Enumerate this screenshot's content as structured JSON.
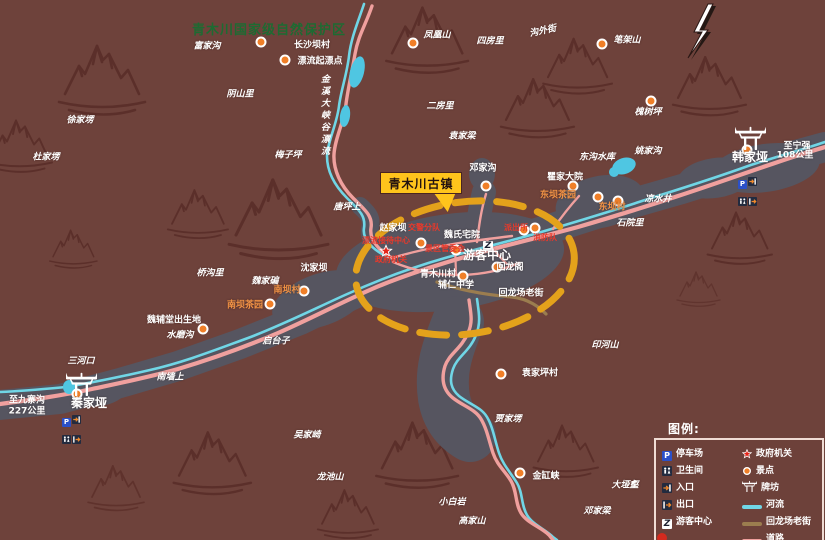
{
  "map": {
    "region_title": "青木川国家级自然保护区",
    "town_callout": "青木川古镇",
    "river_name": "金溪大峡谷漂流",
    "labels": [
      {
        "text": "富家沟",
        "x": 207,
        "y": 47,
        "cls": "wi"
      },
      {
        "text": "长沙坝村",
        "x": 312,
        "y": 46,
        "cls": "w"
      },
      {
        "text": "漂流起漂点",
        "x": 320,
        "y": 62,
        "cls": "w"
      },
      {
        "text": "阴山里",
        "x": 240,
        "y": 95,
        "cls": "wi"
      },
      {
        "text": "徐家塄",
        "x": 80,
        "y": 121,
        "cls": "wi"
      },
      {
        "text": "杜家塄",
        "x": 46,
        "y": 158,
        "cls": "wi"
      },
      {
        "text": "梅子坪",
        "x": 288,
        "y": 156,
        "cls": "wi"
      },
      {
        "text": "唐坪上",
        "x": 347,
        "y": 208,
        "cls": "wi"
      },
      {
        "text": "凤凰山",
        "x": 437,
        "y": 36,
        "cls": "wi"
      },
      {
        "text": "四房里",
        "x": 490,
        "y": 42,
        "cls": "wi"
      },
      {
        "text": "沟外街",
        "x": 543,
        "y": 32,
        "cls": "wi",
        "rot": -12
      },
      {
        "text": "笔架山",
        "x": 627,
        "y": 41,
        "cls": "wi"
      },
      {
        "text": "二房里",
        "x": 440,
        "y": 107,
        "cls": "wi"
      },
      {
        "text": "袁家梁",
        "x": 462,
        "y": 137,
        "cls": "wi"
      },
      {
        "text": "槐树坪",
        "x": 648,
        "y": 113,
        "cls": "wi"
      },
      {
        "text": "邓家沟",
        "x": 483,
        "y": 169,
        "cls": "w"
      },
      {
        "text": "东沟水库",
        "x": 597,
        "y": 158,
        "cls": "wi"
      },
      {
        "text": "姚家沟",
        "x": 648,
        "y": 152,
        "cls": "wi"
      },
      {
        "text": "瞿家大院",
        "x": 565,
        "y": 178,
        "cls": "w"
      },
      {
        "text": "东坝茶园",
        "x": 558,
        "y": 196,
        "cls": "o"
      },
      {
        "text": "东坝村",
        "x": 612,
        "y": 208,
        "cls": "o"
      },
      {
        "text": "凉水井",
        "x": 658,
        "y": 200,
        "cls": "wi"
      },
      {
        "text": "石院里",
        "x": 630,
        "y": 224,
        "cls": "wi"
      },
      {
        "text": "韩家垭",
        "x": 750,
        "y": 157,
        "cls": "big"
      },
      {
        "text": "至宁强",
        "x": 797,
        "y": 147,
        "cls": "w"
      },
      {
        "text": "108公里",
        "x": 795,
        "y": 156,
        "cls": "w"
      },
      {
        "text": "赵家坝",
        "x": 393,
        "y": 229,
        "cls": "w"
      },
      {
        "text": "交警分队",
        "x": 424,
        "y": 228,
        "cls": "r"
      },
      {
        "text": "漂流接待中心",
        "x": 386,
        "y": 241,
        "cls": "r"
      },
      {
        "text": "政府机关",
        "x": 391,
        "y": 260,
        "cls": "r"
      },
      {
        "text": "景区管委会",
        "x": 445,
        "y": 249,
        "cls": "r"
      },
      {
        "text": "魏氏宅院",
        "x": 462,
        "y": 236,
        "cls": "w"
      },
      {
        "text": "游客中心",
        "x": 487,
        "y": 255,
        "cls": "big"
      },
      {
        "text": "派出所",
        "x": 516,
        "y": 228,
        "cls": "r"
      },
      {
        "text": "消防队",
        "x": 545,
        "y": 238,
        "cls": "r"
      },
      {
        "text": "回龙阁",
        "x": 510,
        "y": 268,
        "cls": "w"
      },
      {
        "text": "青木川村",
        "x": 438,
        "y": 275,
        "cls": "w"
      },
      {
        "text": "辅仁中学",
        "x": 456,
        "y": 286,
        "cls": "w"
      },
      {
        "text": "回龙场老街",
        "x": 521,
        "y": 294,
        "cls": "w"
      },
      {
        "text": "沈家坝",
        "x": 314,
        "y": 269,
        "cls": "w"
      },
      {
        "text": "魏家碥",
        "x": 265,
        "y": 282,
        "cls": "wi"
      },
      {
        "text": "桥沟里",
        "x": 210,
        "y": 274,
        "cls": "wi"
      },
      {
        "text": "南坝村",
        "x": 287,
        "y": 291,
        "cls": "o"
      },
      {
        "text": "南坝茶园",
        "x": 245,
        "y": 306,
        "cls": "o"
      },
      {
        "text": "魏辅堂出生地",
        "x": 174,
        "y": 321,
        "cls": "w"
      },
      {
        "text": "水磨沟",
        "x": 180,
        "y": 336,
        "cls": "wi"
      },
      {
        "text": "启台子",
        "x": 276,
        "y": 342,
        "cls": "wi"
      },
      {
        "text": "三河口",
        "x": 81,
        "y": 362,
        "cls": "wi"
      },
      {
        "text": "南墙上",
        "x": 170,
        "y": 378,
        "cls": "wi"
      },
      {
        "text": "秦家垭",
        "x": 89,
        "y": 403,
        "cls": "big"
      },
      {
        "text": "至九寨沟",
        "x": 27,
        "y": 401,
        "cls": "w"
      },
      {
        "text": "227公里",
        "x": 27,
        "y": 412,
        "cls": "w"
      },
      {
        "text": "袁家坪村",
        "x": 540,
        "y": 374,
        "cls": "w"
      },
      {
        "text": "贾家塄",
        "x": 508,
        "y": 420,
        "cls": "wi"
      },
      {
        "text": "印河山",
        "x": 605,
        "y": 346,
        "cls": "wi"
      },
      {
        "text": "金缸峡",
        "x": 546,
        "y": 477,
        "cls": "w"
      },
      {
        "text": "大垭壑",
        "x": 625,
        "y": 486,
        "cls": "wi"
      },
      {
        "text": "邓家梁",
        "x": 597,
        "y": 512,
        "cls": "wi"
      },
      {
        "text": "小白岩",
        "x": 452,
        "y": 503,
        "cls": "wi"
      },
      {
        "text": "高家山",
        "x": 472,
        "y": 522,
        "cls": "wi"
      },
      {
        "text": "吴家崎",
        "x": 307,
        "y": 436,
        "cls": "wi"
      },
      {
        "text": "龙池山",
        "x": 330,
        "y": 478,
        "cls": "wi"
      }
    ],
    "poi_dots": [
      [
        261,
        42
      ],
      [
        285,
        60
      ],
      [
        413,
        43
      ],
      [
        602,
        44
      ],
      [
        651,
        101
      ],
      [
        486,
        186
      ],
      [
        573,
        186
      ],
      [
        598,
        197
      ],
      [
        618,
        201
      ],
      [
        747,
        150
      ],
      [
        421,
        243
      ],
      [
        456,
        250
      ],
      [
        524,
        230
      ],
      [
        535,
        228
      ],
      [
        497,
        267
      ],
      [
        463,
        276
      ],
      [
        304,
        291
      ],
      [
        270,
        304
      ],
      [
        203,
        329
      ],
      [
        77,
        394
      ],
      [
        501,
        374
      ],
      [
        520,
        473
      ]
    ],
    "stars": [
      [
        386,
        251
      ]
    ],
    "visitor_markers": [
      [
        488,
        246
      ]
    ],
    "gates": [
      [
        735,
        125
      ],
      [
        66,
        371
      ]
    ],
    "icon_clusters": [
      {
        "x": 738,
        "y": 171,
        "icons": [
          "parking-icon",
          "entrance-icon",
          "toilet-icon",
          "exit-icon"
        ]
      },
      {
        "x": 62,
        "y": 409,
        "icons": [
          "parking-icon",
          "entrance-icon",
          "toilet-icon",
          "exit-icon"
        ]
      }
    ]
  },
  "legend": {
    "title": "图例:",
    "left": [
      {
        "icon": "parking-icon",
        "label": "停车场"
      },
      {
        "icon": "toilet-icon",
        "label": "卫生间"
      },
      {
        "icon": "entrance-icon",
        "label": "入口"
      },
      {
        "icon": "exit-icon",
        "label": "出口"
      },
      {
        "icon": "visitor-center-icon",
        "label": "游客中心"
      }
    ],
    "right": [
      {
        "icon": "government-star-icon",
        "label": "政府机关"
      },
      {
        "icon": "poi-dot-icon",
        "label": "景点"
      },
      {
        "icon": "paifang-gate-icon",
        "label": "牌坊"
      },
      {
        "icon": "river-line-icon",
        "label": "河流"
      },
      {
        "icon": "old-street-line-icon",
        "label": "回龙场老街"
      },
      {
        "icon": "road-line-icon",
        "label": "道路"
      }
    ]
  },
  "colors": {
    "background": "#6e423b",
    "valley_gray": "#565560",
    "road_pink": "#f0a09e",
    "river_cyan": "#70d6e6",
    "old_street_khaki": "#9b7d4f",
    "highlight_dash": "#e4a21b",
    "callout_yellow": "#ffc41c",
    "poi_orange": "#f07f28",
    "gov_red": "#e3251a",
    "title_green": "#1d6b32",
    "orange_text": "#f09245"
  }
}
